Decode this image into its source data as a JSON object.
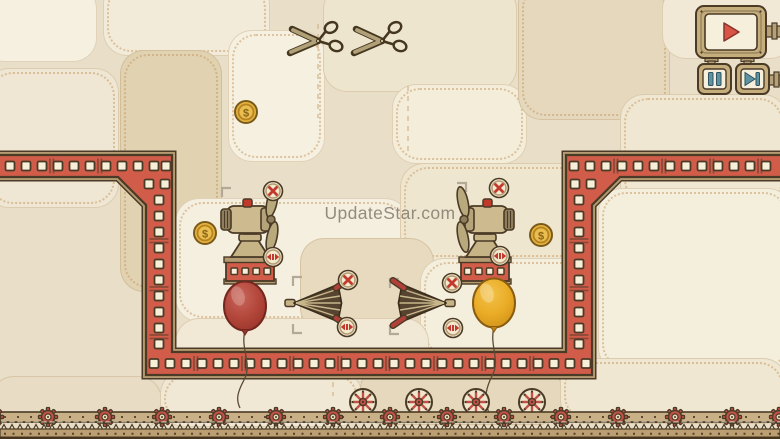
{
  "watermark": {
    "text": "UpdateStar.com"
  },
  "coin": {
    "symbol": "$",
    "count": 3
  },
  "hud": {
    "play": "play",
    "pause": "pause",
    "skip": "skip-forward"
  },
  "level": {
    "balloons": [
      "red",
      "yellow"
    ],
    "fans": 2,
    "umbrellas": 2,
    "scissors": 2,
    "coins": 3
  },
  "colors": {
    "wall_red": "#d15c4a",
    "frame_tan": "#b49b72",
    "outline": "#4a3a26",
    "background": "#e9dfc9",
    "accent_teal": "#5e93a2",
    "coin_gold": "#e6b23f",
    "balloon_red": "#b2453a",
    "balloon_yellow": "#e9ab25",
    "button_red": "#c23a2e"
  }
}
